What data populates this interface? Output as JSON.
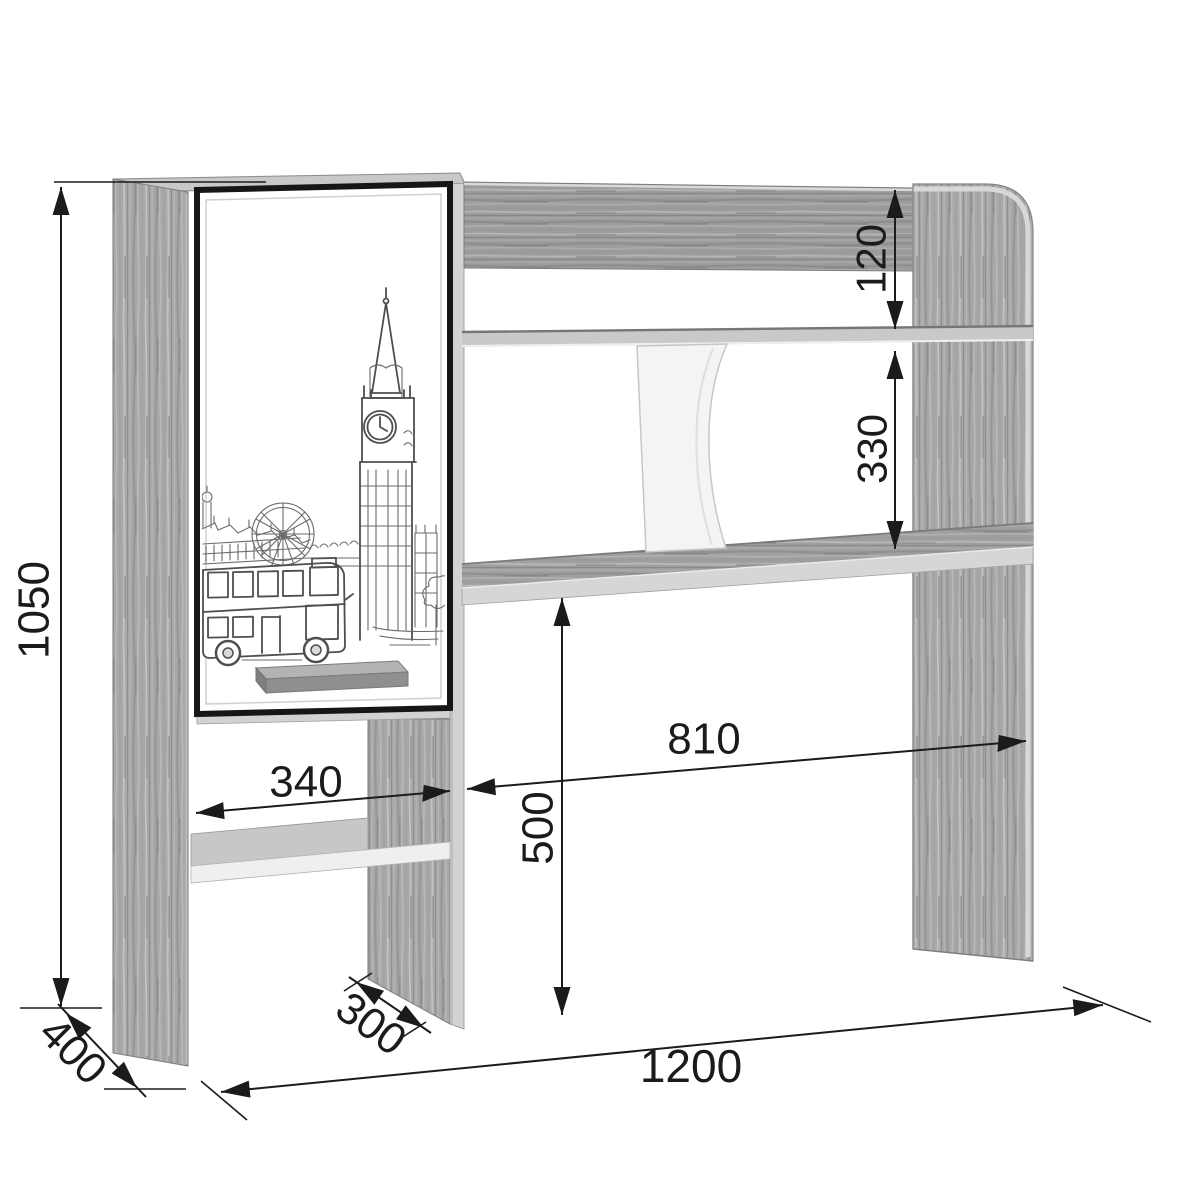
{
  "drawing": {
    "type": "furniture-assembly-dimension-diagram",
    "subject": "desk-hutch-shelf-unit-with-london-print-door",
    "dimensions": {
      "overall_height": "1050",
      "side_depth": "400",
      "lower_niche_width": "340",
      "shelf_depth": "300",
      "overall_width": "1200",
      "desk_opening_width": "810",
      "desk_opening_height": "500",
      "top_shelf_gap": "120",
      "middle_shelf_gap": "330"
    },
    "colors": {
      "dimension_ink": "#1b1b1b",
      "wood_base": "#a6a6a6",
      "edge_band": "#d6d6d6",
      "door_face": "#ffffff",
      "door_frame": "#161616"
    }
  }
}
